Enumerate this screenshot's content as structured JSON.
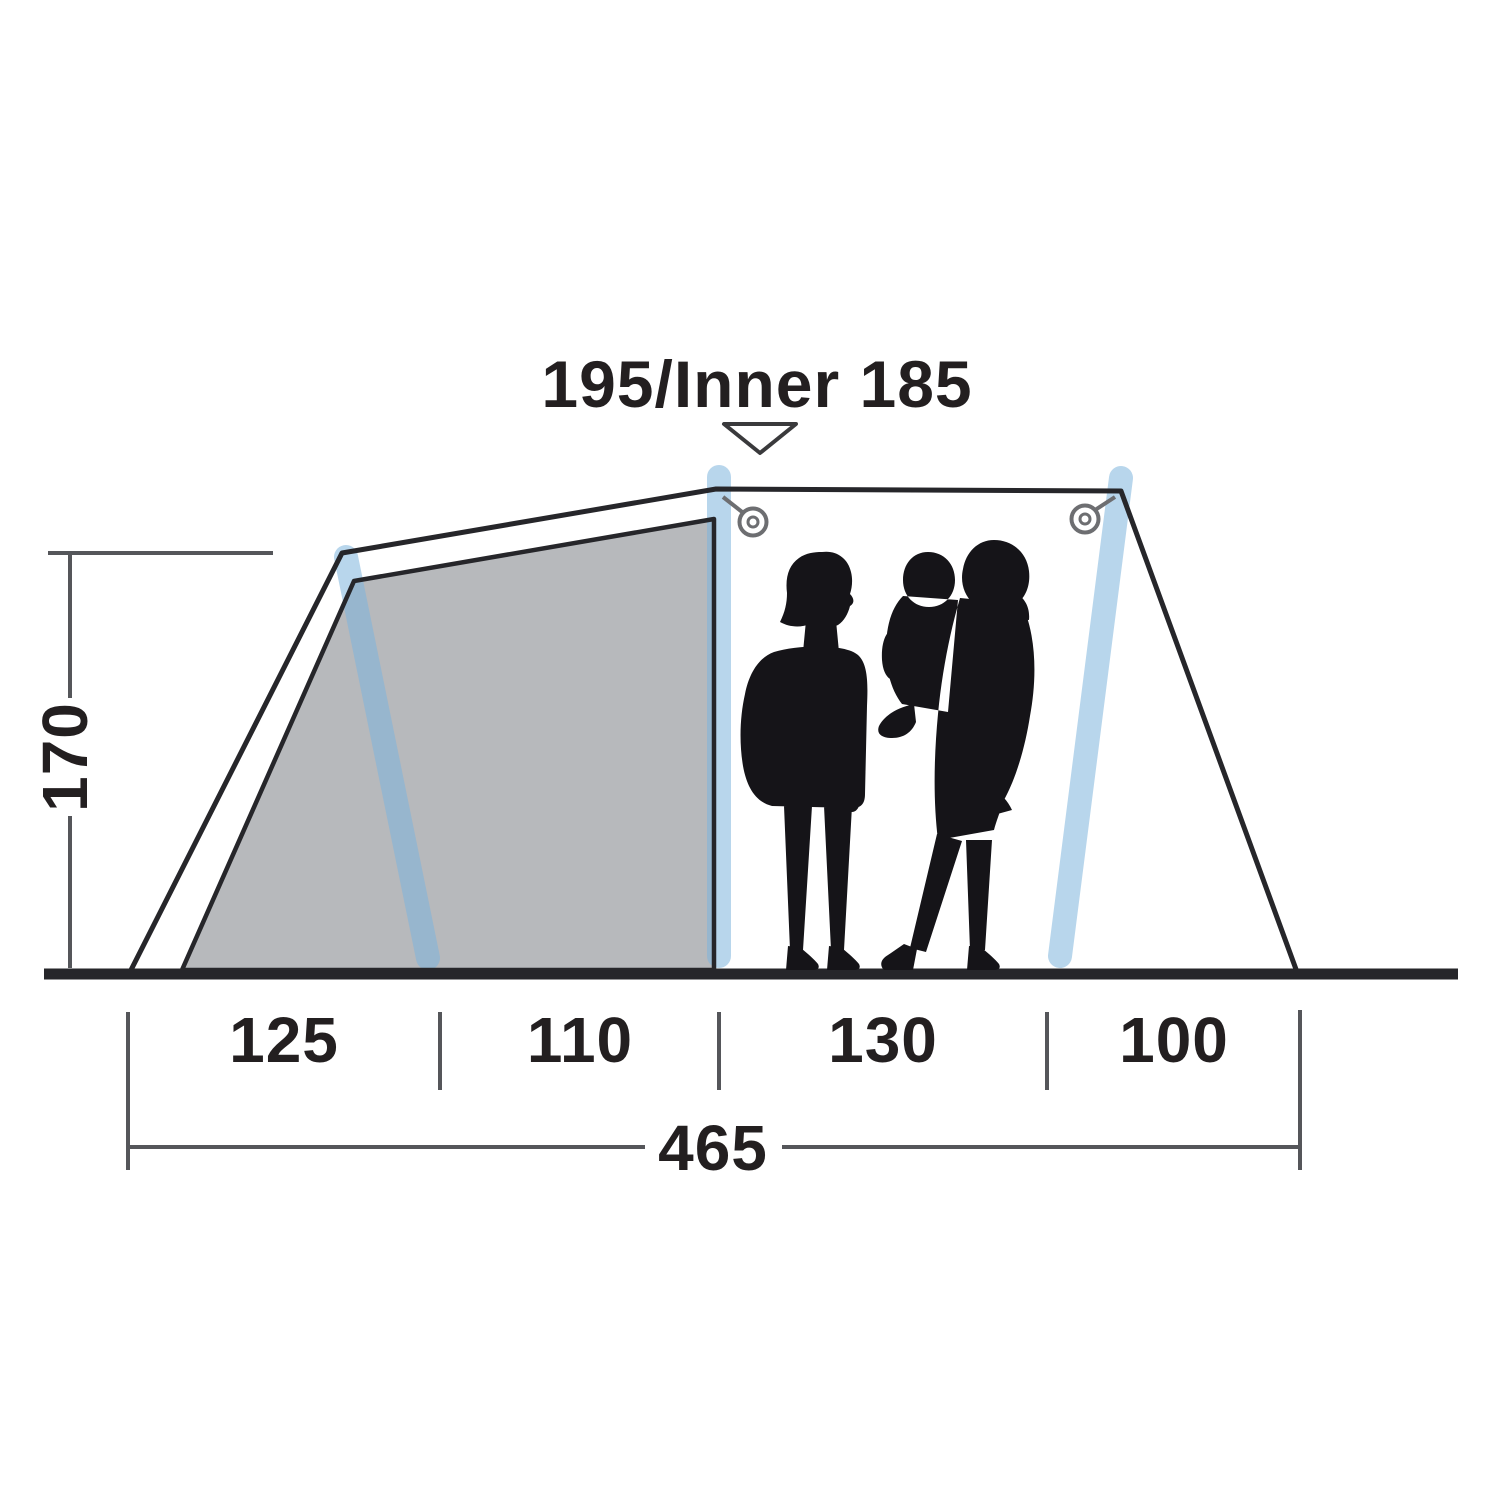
{
  "diagram": {
    "type": "tent-side-profile-dimension-diagram",
    "labels": {
      "peak_height": "195/Inner 185",
      "side_height": "170",
      "seg_1": "125",
      "seg_2": "110",
      "seg_3": "130",
      "seg_4": "100",
      "total_width": "465"
    },
    "colors": {
      "background": "#ffffff",
      "outline": "#26262a",
      "dimension": "#55565a",
      "text": "#231f20",
      "inner_tent_fill": "#b7b9bc",
      "pole": "#7db4dd",
      "ring": "#6d6e71",
      "silhouette": "#151418"
    }
  }
}
